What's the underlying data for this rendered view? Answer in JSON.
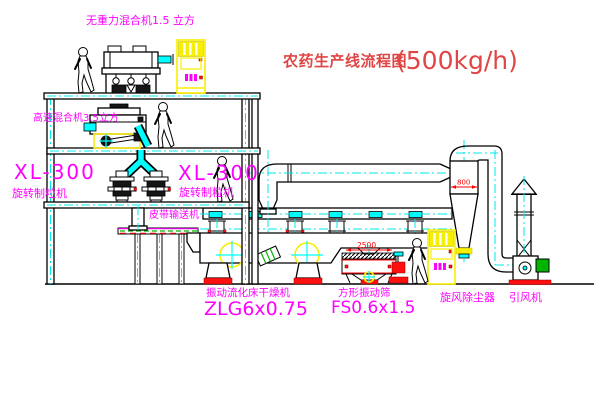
{
  "title": {
    "text": "农药生产线流程图",
    "capacity": "(500kg/h)"
  },
  "labels": {
    "gravity_mixer": "无重力混合机1.5 立方",
    "high_speed_mixer": "高速混合机3.5立方",
    "granulator_left": {
      "model": "XL-300",
      "name": "旋转制粒机"
    },
    "granulator_center": {
      "model": "XL-300",
      "name": "旋转制粒机"
    },
    "belt_conveyor": "皮带输送机",
    "dryer": {
      "name": "振动流化床干燥机",
      "model": "ZLG6x0.75"
    },
    "sieve": {
      "name": "方形振动筛",
      "model": "FS0.6x1.5"
    },
    "cyclone": "旋风除尘器",
    "induced_draft_fan": "引风机"
  },
  "dimensions": {
    "sieve": "2500",
    "cyclone": "800"
  },
  "colors": {
    "label": "#ff00ff",
    "title": "#e04545",
    "dimension": "#ff0000",
    "centerline": "#00e8e8",
    "accent_yellow": "#f7ef00",
    "accent_green": "#00b400",
    "accent_red": "#ff1010",
    "accent_cyan": "#00ffff",
    "line": "#000000",
    "background": "#ffffff"
  }
}
